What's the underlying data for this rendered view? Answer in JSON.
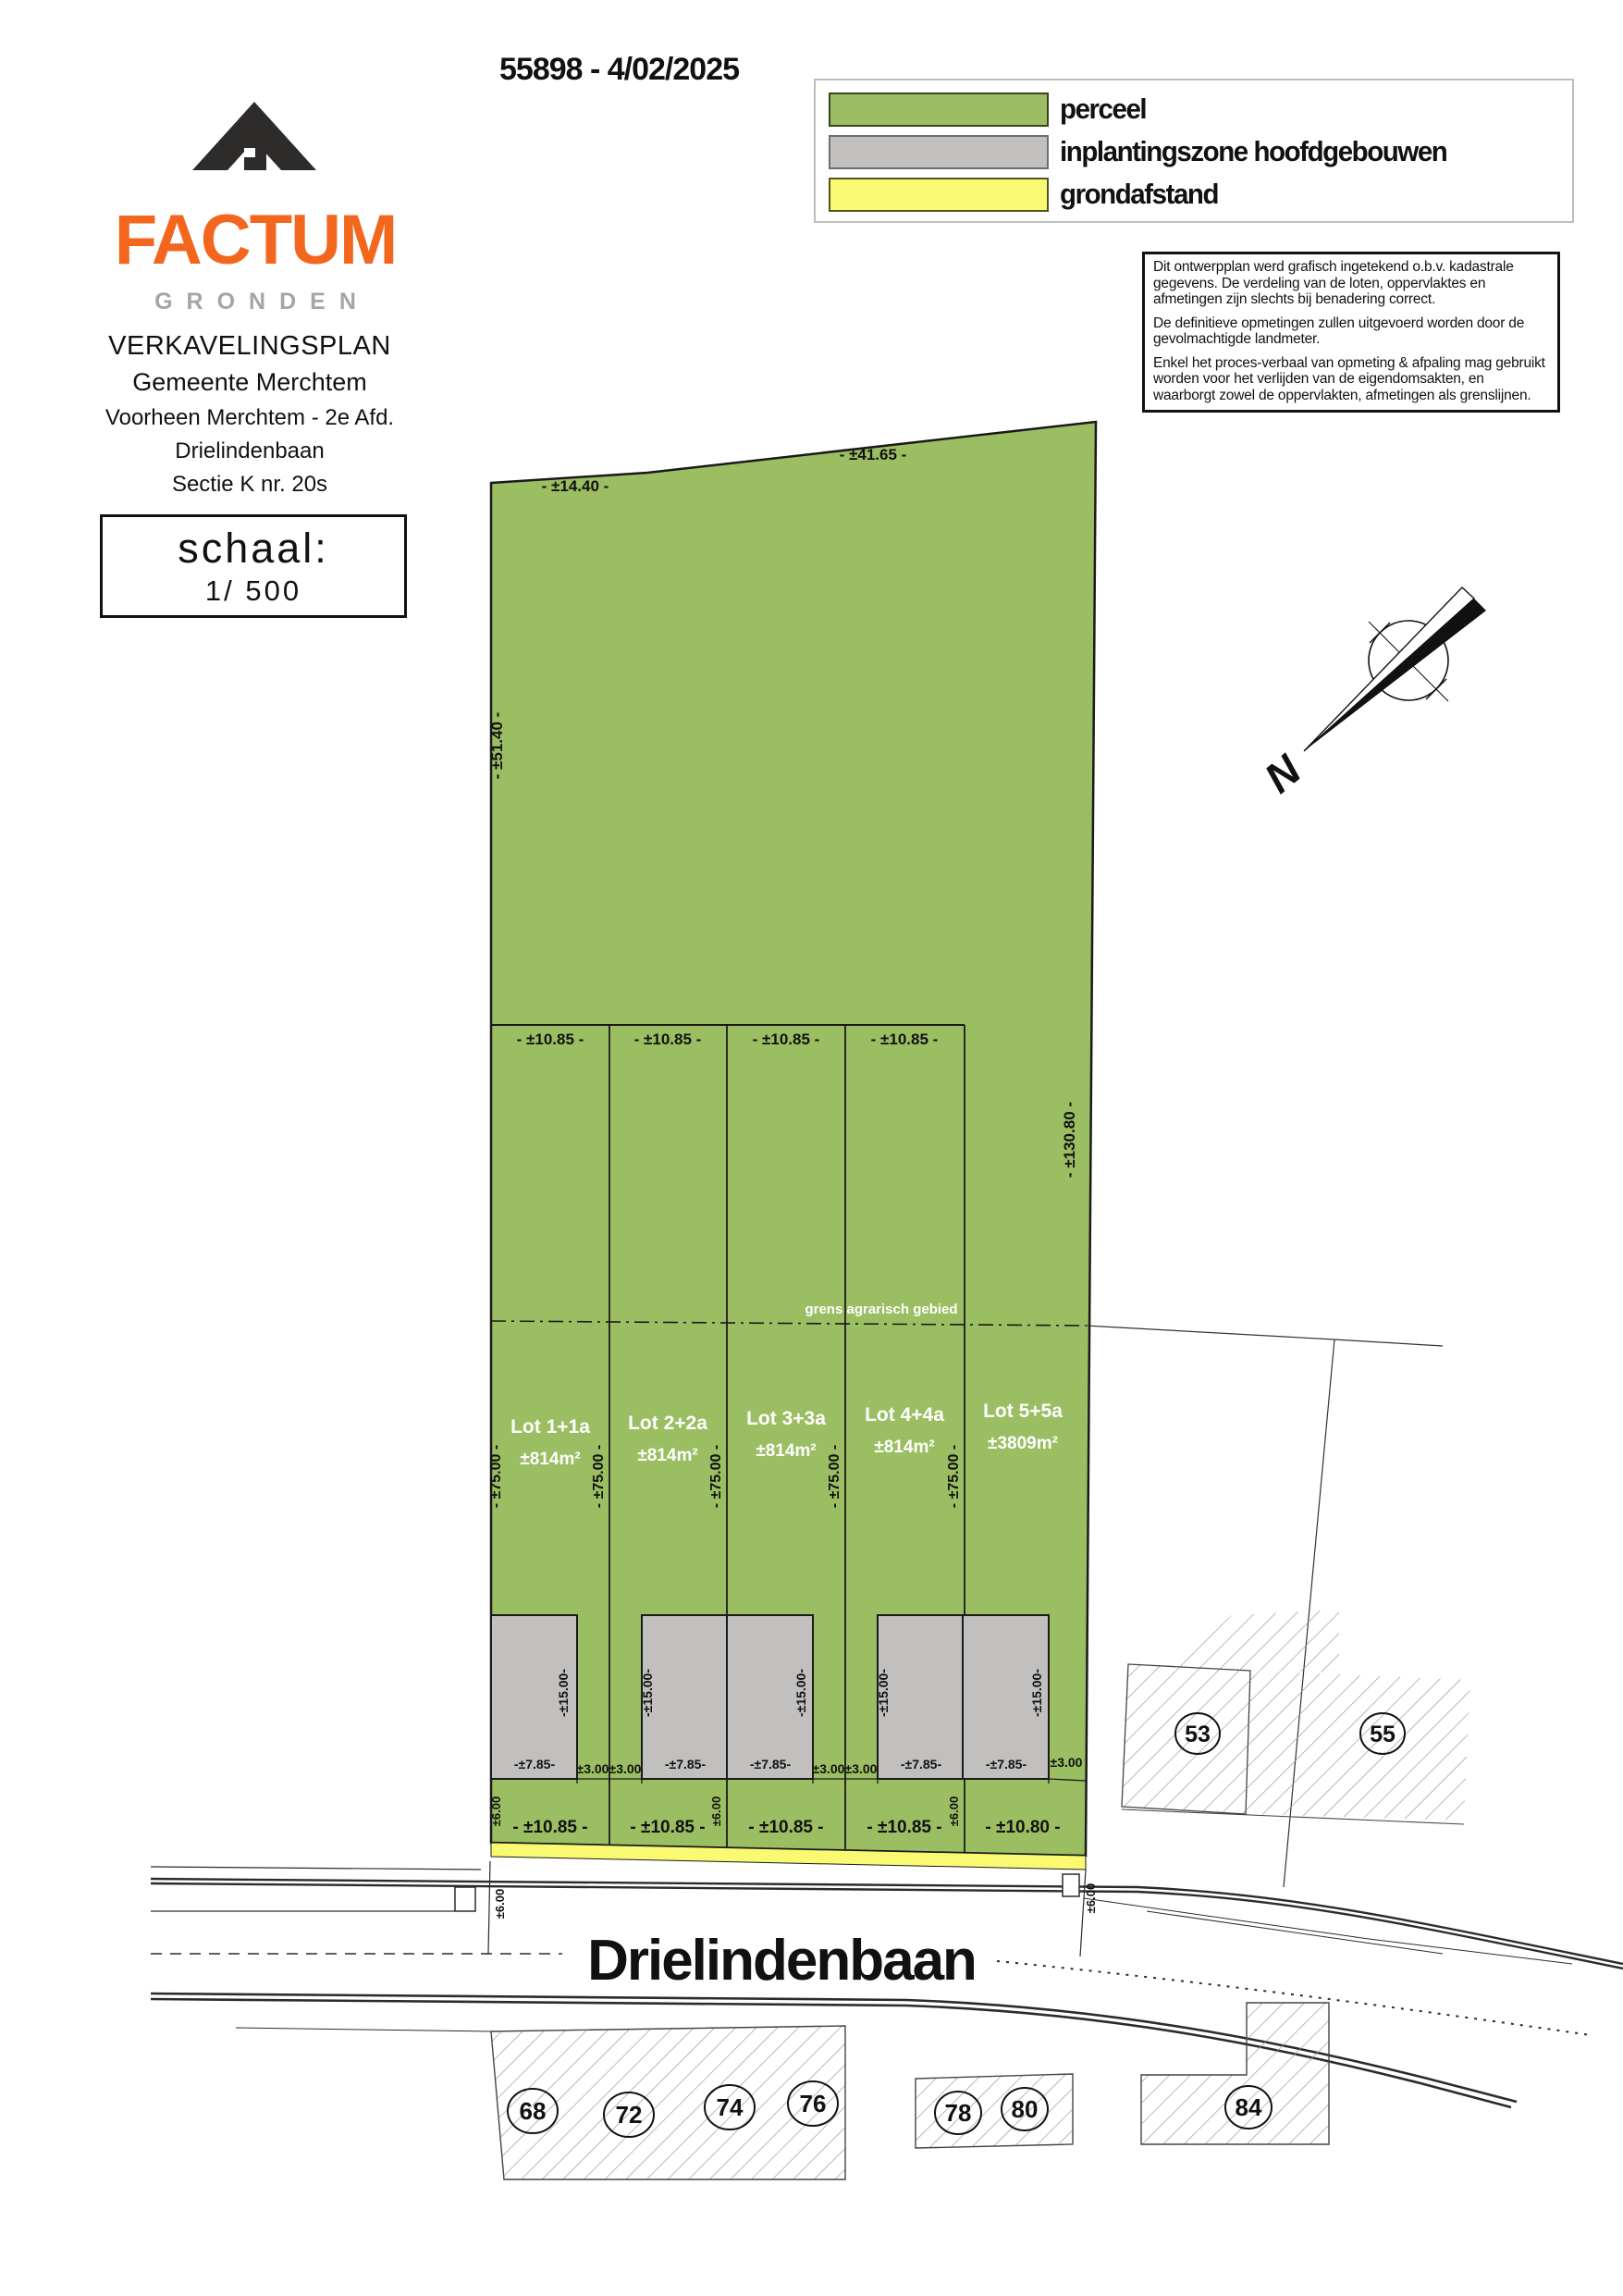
{
  "header": {
    "title": "55898 - 4/02/2025"
  },
  "logo": {
    "name": "FACTUM",
    "subtitle": "GRONDEN"
  },
  "legend": {
    "items": [
      {
        "label": "perceel",
        "color": "#9BBE62"
      },
      {
        "label": "inplantingszone hoofdgebouwen",
        "color": "#C1C0BF"
      },
      {
        "label": "grondafstand",
        "color": "#FAFA72"
      }
    ]
  },
  "disclaimer": {
    "p1": "Dit ontwerpplan werd grafisch ingetekend o.b.v. kadastrale gegevens. De verdeling van de loten, oppervlaktes en afmetingen zijn slechts bij benadering correct.",
    "p2": "De definitieve opmetingen zullen uitgevoerd worden door de gevolmachtigde landmeter.",
    "p3": "Enkel het proces-verbaal van opmeting & afpaling mag gebruikt worden voor het verlijden van de eigendomsakten, en waarborgt zowel de oppervlakten, afmetingen als grenslijnen."
  },
  "project": {
    "line1": "VERKAVELINGSPLAN",
    "line2": "Gemeente Merchtem",
    "line3": "Voorheen Merchtem - 2e Afd.",
    "line4": "Drielindenbaan",
    "line5": "Sectie K nr. 20s",
    "scale_label": "schaal:",
    "scale_value": "1/ 500"
  },
  "plan": {
    "street_name": "Drielindenbaan",
    "boundary_note": "grens agrarisch gebied",
    "north_label": "N",
    "colors": {
      "parcel": "#9BBE62",
      "zone": "#C1C0BF",
      "setback": "#FAFA72"
    },
    "dims": {
      "top_left": "- ±14.40 -",
      "top_right": "- ±41.65 -",
      "left_upper": "- ±51.40 -",
      "right_full": "- ±130.80 -",
      "lot_w": "- ±10.85 -",
      "lot_w_last": "- ±10.80 -",
      "lot_depth": "- ±75.00 -",
      "zone_depth": "-±15.00-",
      "zone_width": "-±7.85-",
      "side_gap": "±3.00",
      "front_gap": "±6.00",
      "road_width": "±6.00"
    },
    "lots": [
      {
        "name": "Lot 1+1a",
        "area": "±814m²"
      },
      {
        "name": "Lot 2+2a",
        "area": "±814m²"
      },
      {
        "name": "Lot 3+3a",
        "area": "±814m²"
      },
      {
        "name": "Lot 4+4a",
        "area": "±814m²"
      },
      {
        "name": "Lot 5+5a",
        "area": "±3809m²"
      }
    ],
    "house_numbers": [
      "68",
      "72",
      "74",
      "76",
      "78",
      "80",
      "84"
    ],
    "neighbor_numbers": [
      "53",
      "55"
    ]
  }
}
